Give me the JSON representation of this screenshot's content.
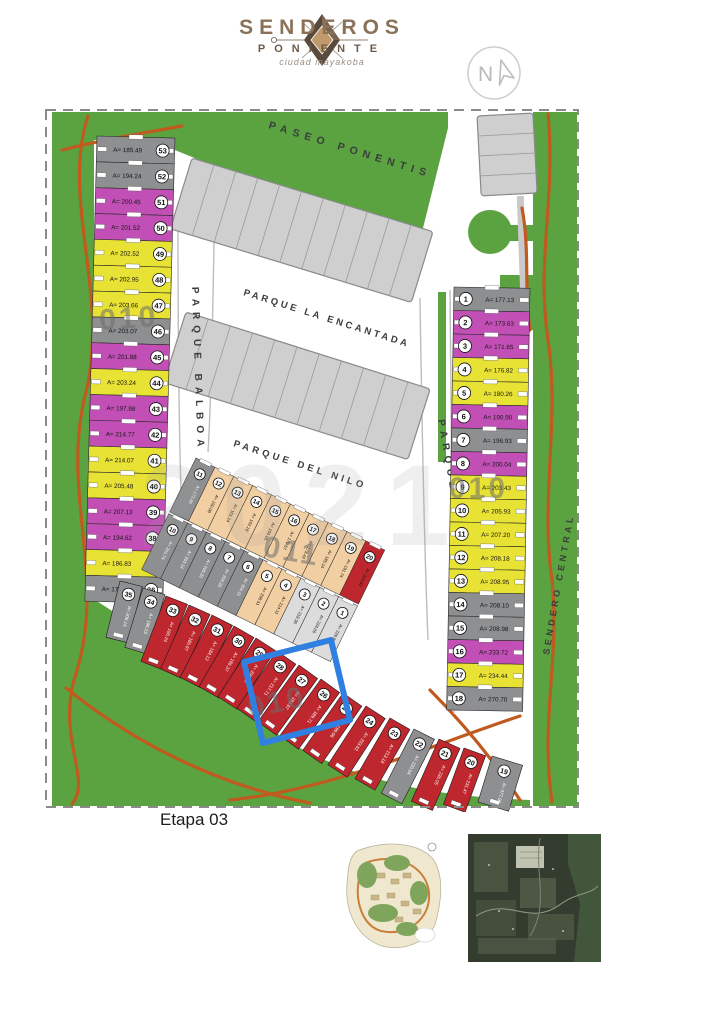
{
  "logo": {
    "title": "SENDEROS",
    "subtitle": "PONIENTE",
    "tagline": "ciudad mayakoba",
    "north": "N"
  },
  "map": {
    "stage_label": "Etapa 03",
    "watermark": "2021",
    "streets": {
      "paseo": "PASEO PONENTIS",
      "encantada": "PARQUE LA ENCANTADA",
      "nilo": "PARQUE DEL NILO",
      "balboa": "PARQUE BALBOA",
      "central": "SENDERO CENTRAL"
    },
    "block_labels": {
      "left": "010",
      "middle": "011",
      "right": "010",
      "bottom": "010"
    },
    "colors": {
      "yellow": "#e8e234",
      "magenta": "#c24fb5",
      "gray": "#8e8f91",
      "red": "#bf272e",
      "beige": "#f1cfa2",
      "light": "#dcdcdc",
      "green": "#5aa340",
      "path": "#c05a1e",
      "highlight": "#2f80e0",
      "block": "#cfcfcf"
    },
    "left_column": {
      "lots": [
        {
          "n": 53,
          "c": "gray",
          "a": "A= 185.49"
        },
        {
          "n": 52,
          "c": "gray",
          "a": "A= 194.24"
        },
        {
          "n": 51,
          "c": "magenta",
          "a": "A= 200.45"
        },
        {
          "n": 50,
          "c": "magenta",
          "a": "A= 201.52"
        },
        {
          "n": 49,
          "c": "yellow",
          "a": "A= 202.52"
        },
        {
          "n": 48,
          "c": "yellow",
          "a": "A= 202.95"
        },
        {
          "n": 47,
          "c": "yellow",
          "a": "A= 203.66"
        },
        {
          "n": 46,
          "c": "gray",
          "a": "A= 203.07"
        },
        {
          "n": 45,
          "c": "magenta",
          "a": "A= 201.88"
        },
        {
          "n": 44,
          "c": "yellow",
          "a": "A= 203.24"
        },
        {
          "n": 43,
          "c": "magenta",
          "a": "A= 197.98"
        },
        {
          "n": 42,
          "c": "magenta",
          "a": "A= 214.77"
        },
        {
          "n": 41,
          "c": "yellow",
          "a": "A= 214.07"
        },
        {
          "n": 40,
          "c": "yellow",
          "a": "A= 205.48"
        },
        {
          "n": 39,
          "c": "magenta",
          "a": "A= 207.13"
        },
        {
          "n": 38,
          "c": "magenta",
          "a": "A= 194.62"
        },
        {
          "n": 37,
          "c": "yellow",
          "a": "A= 186.83"
        },
        {
          "n": 36,
          "c": "gray",
          "a": "A= 177.00"
        }
      ]
    },
    "right_column": {
      "lots": [
        {
          "n": 1,
          "c": "gray",
          "a": "A= 177.13"
        },
        {
          "n": 2,
          "c": "magenta",
          "a": "A= 173.63"
        },
        {
          "n": 3,
          "c": "magenta",
          "a": "A= 171.65"
        },
        {
          "n": 4,
          "c": "yellow",
          "a": "A= 176.82"
        },
        {
          "n": 5,
          "c": "yellow",
          "a": "A= 180.26"
        },
        {
          "n": 6,
          "c": "magenta",
          "a": "A= 190.90"
        },
        {
          "n": 7,
          "c": "gray",
          "a": "A= 196.93"
        },
        {
          "n": 8,
          "c": "magenta",
          "a": "A= 200.04"
        },
        {
          "n": 9,
          "c": "yellow",
          "a": "A= 203.43"
        },
        {
          "n": 10,
          "c": "yellow",
          "a": "A= 205.93"
        },
        {
          "n": 11,
          "c": "yellow",
          "a": "A= 207.20"
        },
        {
          "n": 12,
          "c": "yellow",
          "a": "A= 208.18"
        },
        {
          "n": 13,
          "c": "yellow",
          "a": "A= 208.95"
        },
        {
          "n": 14,
          "c": "gray",
          "a": "A= 208.10"
        },
        {
          "n": 15,
          "c": "gray",
          "a": "A= 208.98"
        },
        {
          "n": 16,
          "c": "magenta",
          "a": "A= 233.72"
        },
        {
          "n": 17,
          "c": "yellow",
          "a": "A= 234.44"
        },
        {
          "n": 18,
          "c": "gray",
          "a": "A= 270.70"
        }
      ]
    },
    "middle_block": {
      "top_row": [
        {
          "n": 11,
          "c": "gray",
          "a": "A= 173.85"
        },
        {
          "n": 12,
          "c": "beige",
          "a": "A= 160.08"
        },
        {
          "n": 13,
          "c": "beige",
          "a": "A= 161.14"
        },
        {
          "n": 14,
          "c": "beige",
          "a": "A= 163.18"
        },
        {
          "n": 15,
          "c": "beige",
          "a": "A= 165.06"
        },
        {
          "n": 16,
          "c": "beige",
          "a": "A= 170.57"
        },
        {
          "n": 17,
          "c": "beige",
          "a": "A= 178.42"
        },
        {
          "n": 18,
          "c": "beige",
          "a": "A= 185.14"
        },
        {
          "n": 19,
          "c": "beige",
          "a": "A= 191.74"
        },
        {
          "n": 20,
          "c": "red",
          "a": "A= 203.82"
        }
      ],
      "bottom_row": [
        {
          "n": 10,
          "c": "gray",
          "a": "A= 201.74"
        },
        {
          "n": 9,
          "c": "gray",
          "a": "A= 203.14"
        },
        {
          "n": 8,
          "c": "gray",
          "a": "A= 205.36"
        },
        {
          "n": 7,
          "c": "gray",
          "a": "A= 206.28"
        },
        {
          "n": 6,
          "c": "gray",
          "a": "A= 204.11"
        },
        {
          "n": 5,
          "c": "beige",
          "a": "A= 208.51"
        },
        {
          "n": 4,
          "c": "beige",
          "a": "A= 214.11"
        },
        {
          "n": 3,
          "c": "light",
          "a": "A= 219.30"
        },
        {
          "n": 2,
          "c": "light",
          "a": "A= 224.06"
        },
        {
          "n": 1,
          "c": "light",
          "a": "A= 229.82"
        }
      ]
    },
    "bottom_strip": {
      "lots": [
        {
          "n": 35,
          "c": "gray",
          "a": "A= 208.14"
        },
        {
          "n": 34,
          "c": "gray",
          "a": "A= 196.23"
        },
        {
          "n": 33,
          "c": "red",
          "a": "A= 190.24"
        },
        {
          "n": 32,
          "c": "red",
          "a": "A= 186.97"
        },
        {
          "n": 31,
          "c": "red",
          "a": "A= 184.12"
        },
        {
          "n": 30,
          "c": "red",
          "a": "A= 186.37"
        },
        {
          "n": 29,
          "c": "red",
          "a": "A= 206.75"
        },
        {
          "n": 28,
          "c": "red",
          "a": "A= 217.71",
          "hl": true
        },
        {
          "n": 27,
          "c": "red",
          "a": "A= 192.67",
          "hl": true
        },
        {
          "n": 26,
          "c": "red",
          "a": "A= 189.71"
        },
        {
          "n": 25,
          "c": "red",
          "a": "A= 199.96"
        },
        {
          "n": 24,
          "c": "red",
          "a": "A= 203.62"
        },
        {
          "n": 23,
          "c": "red",
          "a": "A= 213.18"
        },
        {
          "n": 22,
          "c": "gray",
          "a": "A= 220.64"
        },
        {
          "n": 21,
          "c": "red",
          "a": "A= 236.05"
        },
        {
          "n": 20,
          "c": "red",
          "a": "A= 231.47"
        },
        {
          "n": 19,
          "c": "gray",
          "a": "A= 377.90"
        }
      ]
    },
    "highlight": {
      "lots": "27-28"
    }
  },
  "thumbnails": {
    "masterplan": "masterplan-map",
    "satellite": "satellite-map"
  }
}
